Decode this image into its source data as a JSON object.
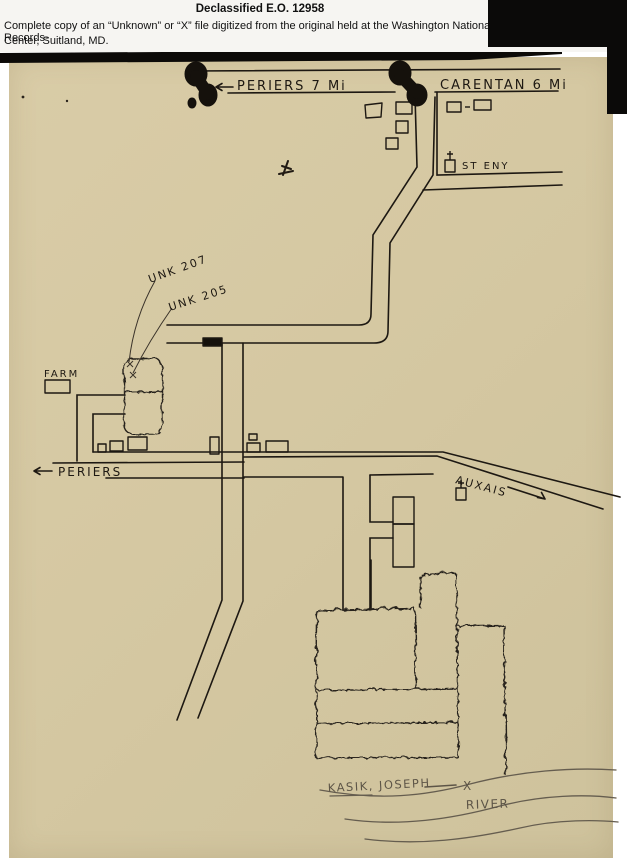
{
  "header": {
    "line1": "Declassified E.O. 12958",
    "line2": "Complete copy of an “Unknown” or “X” file digitized from the original held at the Washington National Records-",
    "line3": "Center, Suitland, MD."
  },
  "map": {
    "labels": {
      "periers_top": "PERIERS  7 Mi",
      "carentan": "CARENTAN  6 Mi",
      "st_eny": "ST ENY",
      "unk_207": "UNK 207",
      "unk_205": "UNK 205",
      "farm": "FARM",
      "periers_left": "PERIERS",
      "auxais": "AUXAIS",
      "kasik": "KASIK, JOSEPH",
      "x_mark": "X",
      "river": "RIVER"
    },
    "colors": {
      "paper": "#d5c8a2",
      "ink": "#1d1812",
      "pencil": "#5d5547",
      "redaction": "#0b0a09",
      "header_bg": "#f6f5f2"
    }
  }
}
